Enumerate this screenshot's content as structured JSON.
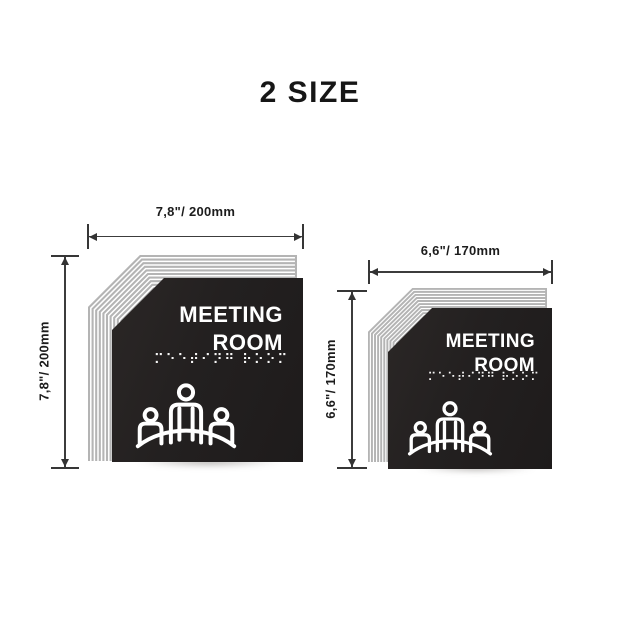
{
  "title": "2 SIZE",
  "signs": [
    {
      "id": "large",
      "width_label": "7,8\"/ 200mm",
      "height_label": "7,8\"/ 200mm",
      "title_line1": "MEETING",
      "title_line2": "ROOM",
      "braille": "⠍⠑⠑⠞⠊⠝⠛ ⠗⠕⠕⠍",
      "icon": "meeting-people-table-icon"
    },
    {
      "id": "small",
      "width_label": "6,6\"/ 170mm",
      "height_label": "6,6\"/ 170mm",
      "title_line1": "MEETING",
      "title_line2": "ROOM",
      "braille": "⠍⠑⠑⠞⠊⠝⠛ ⠗⠕⠕⠍",
      "icon": "meeting-people-table-icon"
    }
  ],
  "colors": {
    "background": "#ffffff",
    "sign_panel": "#232020",
    "stripe_silver": "#b4b4b4",
    "sign_text": "#ffffff",
    "dimension_ink": "#2f2f2f"
  }
}
